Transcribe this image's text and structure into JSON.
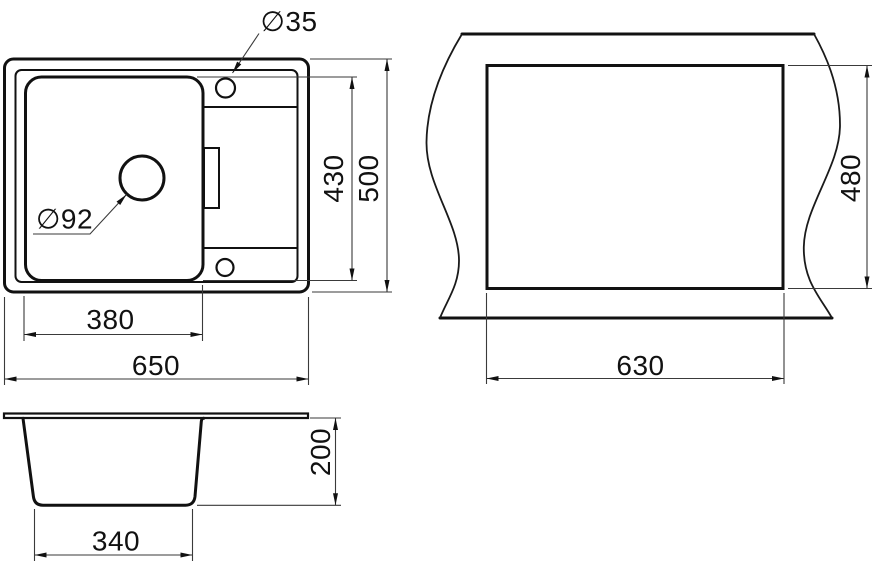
{
  "drawing": {
    "background": "#ffffff",
    "line_color": "#111111",
    "views": {
      "top_view": {
        "dimensions": {
          "faucet_hole_diameter": "∅35",
          "drain_hole_diameter": "∅92",
          "bowl_depth": "430",
          "overall_depth": "500",
          "bowl_width": "380",
          "overall_width": "650"
        }
      },
      "cutout_view": {
        "dimensions": {
          "cutout_depth": "480",
          "cutout_width": "630"
        }
      },
      "side_view": {
        "dimensions": {
          "bowl_height": "200",
          "bowl_bottom_width": "340"
        }
      }
    }
  }
}
